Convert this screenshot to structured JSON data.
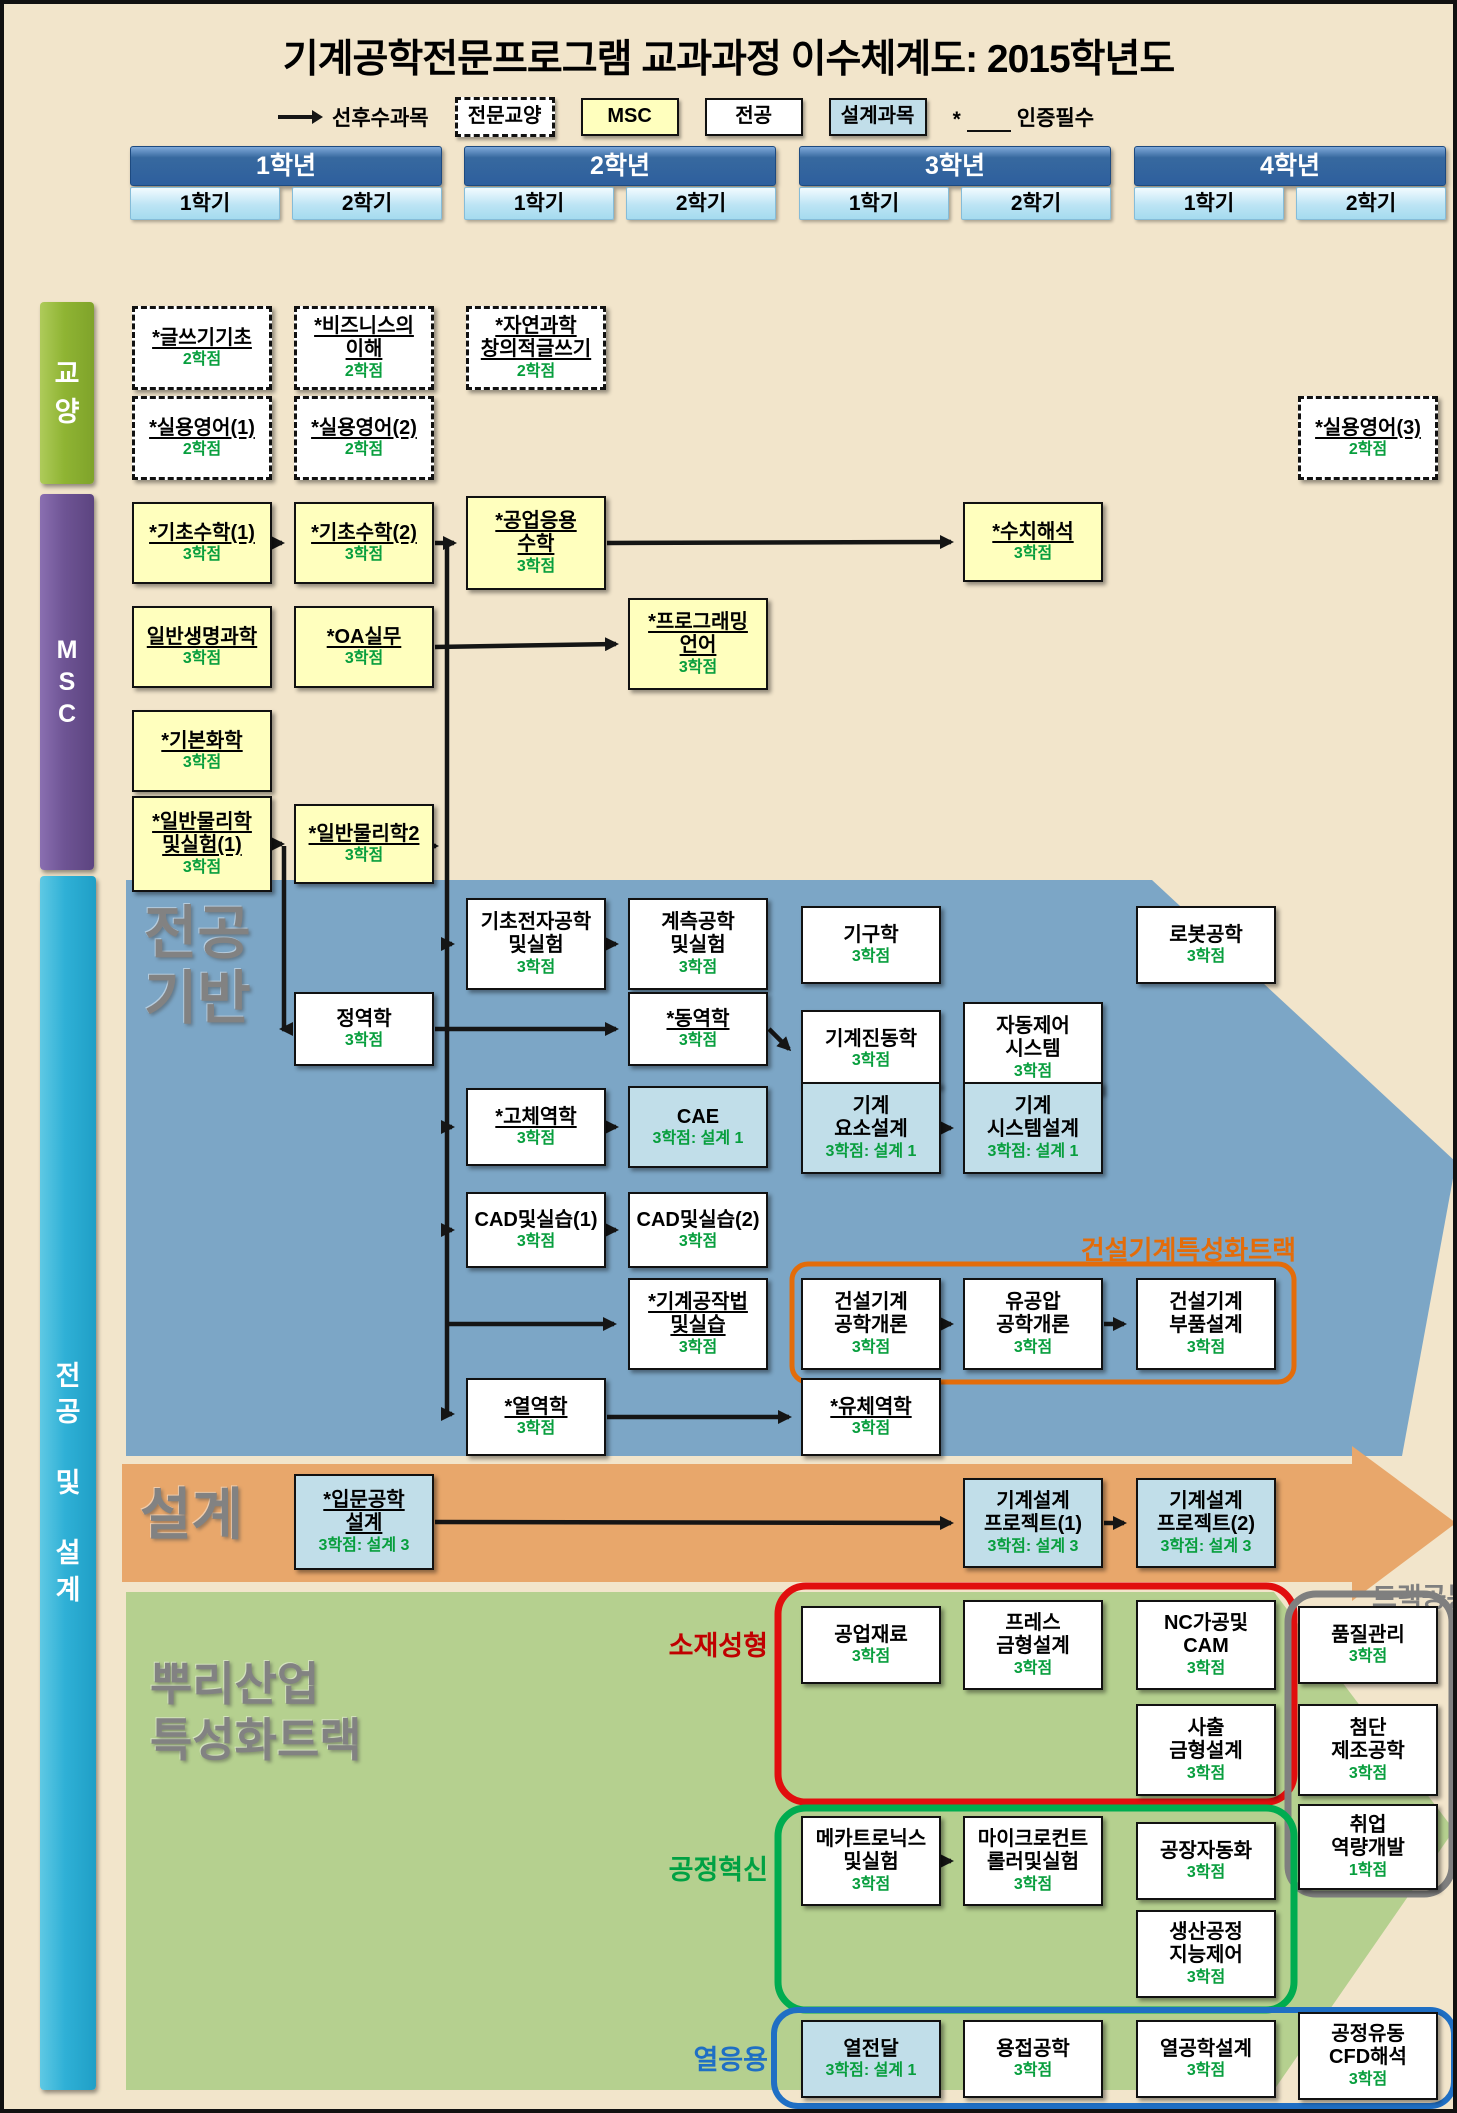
{
  "title": "기계공학전문프로그램 교과과정 이수체계도: 2015학년도",
  "legend": {
    "arrow_label": "선후수과목",
    "items": [
      {
        "label": "전문교양",
        "type": "liberal"
      },
      {
        "label": "MSC",
        "type": "msc"
      },
      {
        "label": "전공",
        "type": "major"
      },
      {
        "label": "설계과목",
        "type": "design"
      }
    ],
    "required_mark": "*",
    "required_label": "인증필수"
  },
  "years": [
    {
      "label": "1학년",
      "semesters": [
        "1학기",
        "2학기"
      ]
    },
    {
      "label": "2학년",
      "semesters": [
        "1학기",
        "2학기"
      ]
    },
    {
      "label": "3학년",
      "semesters": [
        "1학기",
        "2학기"
      ]
    },
    {
      "label": "4학년",
      "semesters": [
        "1학기",
        "2학기"
      ]
    }
  ],
  "side_sections": [
    {
      "label": "교양",
      "color": "#8FB433"
    },
    {
      "label": "MSC",
      "color": "#6E5494"
    },
    {
      "label": "전공 및 설계",
      "color": "#2FB0D6"
    }
  ],
  "regions": [
    {
      "id": "major-base",
      "label": "전공\n기반",
      "color": "#7CA6C6"
    },
    {
      "id": "design-band",
      "label": "설계",
      "color": "#E8A76B"
    },
    {
      "id": "root-industry",
      "label": "뿌리산업\n특성화트랙",
      "color": "#B5D08F"
    }
  ],
  "track_labels": [
    {
      "id": "construction",
      "text": "건설기계특성화트랙",
      "color": "#E36C0A"
    },
    {
      "id": "common",
      "text": "트랙공통",
      "color": "#7F7F7F"
    },
    {
      "id": "material",
      "text": "소재성형",
      "color": "#C00000"
    },
    {
      "id": "process",
      "text": "공정혁신",
      "color": "#00A143"
    },
    {
      "id": "thermal",
      "text": "열응용",
      "color": "#1F6FC4"
    }
  ],
  "courses": [
    {
      "id": "gs",
      "col": "1-1",
      "y": 302,
      "h": 84,
      "type": "liberal",
      "u": true,
      "lines": [
        "*글쓰기기초"
      ],
      "credit": "2학점"
    },
    {
      "id": "biz",
      "col": "1-2",
      "y": 302,
      "h": 84,
      "type": "liberal",
      "u": true,
      "lines": [
        "*비즈니스의",
        "이해"
      ],
      "credit": "2학점"
    },
    {
      "id": "nat",
      "col": "2-1",
      "y": 302,
      "h": 84,
      "type": "liberal",
      "u": true,
      "lines": [
        "*자연과학",
        "창의적글쓰기"
      ],
      "credit": "2학점"
    },
    {
      "id": "eng1",
      "col": "1-1",
      "y": 392,
      "h": 84,
      "type": "liberal",
      "u": true,
      "lines": [
        "*실용영어(1)"
      ],
      "credit": "2학점"
    },
    {
      "id": "eng2",
      "col": "1-2",
      "y": 392,
      "h": 84,
      "type": "liberal",
      "u": true,
      "lines": [
        "*실용영어(2)"
      ],
      "credit": "2학점"
    },
    {
      "id": "eng3",
      "col": "4-2",
      "y": 392,
      "h": 84,
      "type": "liberal",
      "u": true,
      "lines": [
        "*실용영어(3)"
      ],
      "credit": "2학점"
    },
    {
      "id": "math1",
      "col": "1-1",
      "y": 498,
      "h": 82,
      "type": "msc",
      "u": true,
      "lines": [
        "*기초수학(1)"
      ],
      "credit": "3학점"
    },
    {
      "id": "math2",
      "col": "1-2",
      "y": 498,
      "h": 82,
      "type": "msc",
      "u": true,
      "lines": [
        "*기초수학(2)"
      ],
      "credit": "3학점"
    },
    {
      "id": "engmath",
      "col": "2-1",
      "y": 492,
      "h": 94,
      "type": "msc",
      "u": true,
      "lines": [
        "*공업응용",
        "수학"
      ],
      "credit": "3학점"
    },
    {
      "id": "numan",
      "col": "3-2",
      "y": 498,
      "h": 80,
      "type": "msc",
      "u": true,
      "lines": [
        "*수치해석"
      ],
      "credit": "3학점"
    },
    {
      "id": "bio",
      "col": "1-1",
      "y": 602,
      "h": 82,
      "type": "msc",
      "u": true,
      "lines": [
        "일반생명과학"
      ],
      "credit": "3학점"
    },
    {
      "id": "oa",
      "col": "1-2",
      "y": 602,
      "h": 82,
      "type": "msc",
      "u": true,
      "lines": [
        "*OA실무"
      ],
      "credit": "3학점"
    },
    {
      "id": "prog",
      "col": "2-2",
      "y": 594,
      "h": 92,
      "type": "msc",
      "u": true,
      "lines": [
        "*프로그래밍",
        "언어"
      ],
      "credit": "3학점"
    },
    {
      "id": "chem",
      "col": "1-1",
      "y": 706,
      "h": 82,
      "type": "msc",
      "u": true,
      "lines": [
        "*기본화학"
      ],
      "credit": "3학점"
    },
    {
      "id": "phys1",
      "col": "1-1",
      "y": 792,
      "h": 96,
      "type": "msc",
      "u": true,
      "lines": [
        "*일반물리학",
        "및실험(1)"
      ],
      "credit": "3학점"
    },
    {
      "id": "phys2",
      "col": "1-2",
      "y": 800,
      "h": 80,
      "type": "msc",
      "u": true,
      "lines": [
        "*일반물리학2"
      ],
      "credit": "3학점"
    },
    {
      "id": "elec",
      "col": "2-1",
      "y": 894,
      "h": 92,
      "type": "major",
      "lines": [
        "기초전자공학",
        "및실험"
      ],
      "credit": "3학점"
    },
    {
      "id": "meas",
      "col": "2-2",
      "y": 894,
      "h": 92,
      "type": "major",
      "lines": [
        "계측공학",
        "및실험"
      ],
      "credit": "3학점"
    },
    {
      "id": "mech",
      "col": "3-1",
      "y": 902,
      "h": 78,
      "type": "major",
      "lines": [
        "기구학"
      ],
      "credit": "3학점"
    },
    {
      "id": "robot",
      "col": "4-1",
      "y": 902,
      "h": 78,
      "type": "major",
      "lines": [
        "로봇공학"
      ],
      "credit": "3학점"
    },
    {
      "id": "statics",
      "col": "1-2",
      "y": 988,
      "h": 74,
      "type": "major",
      "lines": [
        "정역학"
      ],
      "credit": "3학점"
    },
    {
      "id": "dyn",
      "col": "2-2",
      "y": 988,
      "h": 74,
      "type": "major",
      "u": true,
      "lines": [
        "*동역학"
      ],
      "credit": "3학점"
    },
    {
      "id": "vib",
      "col": "3-1",
      "y": 1006,
      "h": 78,
      "type": "major",
      "lines": [
        "기계진동학"
      ],
      "credit": "3학점"
    },
    {
      "id": "auto",
      "col": "3-2",
      "y": 998,
      "h": 92,
      "type": "major",
      "lines": [
        "자동제어",
        "시스템"
      ],
      "credit": "3학점"
    },
    {
      "id": "solid",
      "col": "2-1",
      "y": 1084,
      "h": 78,
      "type": "major",
      "u": true,
      "lines": [
        "*고체역학"
      ],
      "credit": "3학점"
    },
    {
      "id": "cae",
      "col": "2-2",
      "y": 1082,
      "h": 82,
      "type": "design",
      "lines": [
        "CAE"
      ],
      "credit": "3학점: 설계 1"
    },
    {
      "id": "machel",
      "col": "3-1",
      "y": 1078,
      "h": 92,
      "type": "design",
      "lines": [
        "기계",
        "요소설계"
      ],
      "credit": "3학점: 설계 1"
    },
    {
      "id": "macsys",
      "col": "3-2",
      "y": 1078,
      "h": 92,
      "type": "design",
      "lines": [
        "기계",
        "시스템설계"
      ],
      "credit": "3학점: 설계 1"
    },
    {
      "id": "cad1",
      "col": "2-1",
      "y": 1188,
      "h": 76,
      "type": "major",
      "lines": [
        "CAD및실습(1)"
      ],
      "credit": "3학점"
    },
    {
      "id": "cad2",
      "col": "2-2",
      "y": 1188,
      "h": 76,
      "type": "major",
      "lines": [
        "CAD및실습(2)"
      ],
      "credit": "3학점"
    },
    {
      "id": "manuf",
      "col": "2-2",
      "y": 1274,
      "h": 92,
      "type": "major",
      "u": true,
      "lines": [
        "*기계공작법",
        "및실습"
      ],
      "credit": "3학점"
    },
    {
      "id": "conint",
      "col": "3-1",
      "y": 1274,
      "h": 92,
      "type": "major",
      "lines": [
        "건설기계",
        "공학개론"
      ],
      "credit": "3학점"
    },
    {
      "id": "hydr",
      "col": "3-2",
      "y": 1274,
      "h": 92,
      "type": "major",
      "lines": [
        "유공압",
        "공학개론"
      ],
      "credit": "3학점"
    },
    {
      "id": "conpart",
      "col": "4-1",
      "y": 1274,
      "h": 92,
      "type": "major",
      "lines": [
        "건설기계",
        "부품설계"
      ],
      "credit": "3학점"
    },
    {
      "id": "thermo",
      "col": "2-1",
      "y": 1374,
      "h": 78,
      "type": "major",
      "u": true,
      "lines": [
        "*열역학"
      ],
      "credit": "3학점"
    },
    {
      "id": "fluid",
      "col": "3-1",
      "y": 1374,
      "h": 78,
      "type": "major",
      "u": true,
      "lines": [
        "*유체역학"
      ],
      "credit": "3학점"
    },
    {
      "id": "introdes",
      "col": "1-2",
      "y": 1470,
      "h": 96,
      "type": "design",
      "u": true,
      "lines": [
        "*입문공학",
        "설계"
      ],
      "credit": "3학점: 설계 3"
    },
    {
      "id": "proj1",
      "col": "3-2",
      "y": 1474,
      "h": 90,
      "type": "design",
      "lines": [
        "기계설계",
        "프로젝트(1)"
      ],
      "credit": "3학점: 설계 3"
    },
    {
      "id": "proj2",
      "col": "4-1",
      "y": 1474,
      "h": 90,
      "type": "design",
      "lines": [
        "기계설계",
        "프로젝트(2)"
      ],
      "credit": "3학점: 설계 3"
    },
    {
      "id": "indmat",
      "col": "3-1",
      "y": 1602,
      "h": 78,
      "type": "major",
      "lines": [
        "공업재료"
      ],
      "credit": "3학점"
    },
    {
      "id": "press",
      "col": "3-2",
      "y": 1596,
      "h": 90,
      "type": "major",
      "lines": [
        "프레스",
        "금형설계"
      ],
      "credit": "3학점"
    },
    {
      "id": "nccam",
      "col": "4-1",
      "y": 1596,
      "h": 90,
      "type": "major",
      "lines": [
        "NC가공및",
        "CAM"
      ],
      "credit": "3학점"
    },
    {
      "id": "quality",
      "col": "4-2",
      "y": 1602,
      "h": 78,
      "type": "major",
      "lines": [
        "품질관리"
      ],
      "credit": "3학점"
    },
    {
      "id": "inject",
      "col": "4-1",
      "y": 1700,
      "h": 92,
      "type": "major",
      "lines": [
        "사출",
        "금형설계"
      ],
      "credit": "3학점"
    },
    {
      "id": "advman",
      "col": "4-2",
      "y": 1700,
      "h": 92,
      "type": "major",
      "lines": [
        "첨단",
        "제조공학"
      ],
      "credit": "3학점"
    },
    {
      "id": "mecha",
      "col": "3-1",
      "y": 1812,
      "h": 90,
      "type": "major",
      "lines": [
        "메카트로닉스",
        "및실험"
      ],
      "credit": "3학점"
    },
    {
      "id": "micro",
      "col": "3-2",
      "y": 1812,
      "h": 90,
      "type": "major",
      "lines": [
        "마이크로컨트",
        "롤러및실험"
      ],
      "credit": "3학점"
    },
    {
      "id": "factauto",
      "col": "4-1",
      "y": 1818,
      "h": 78,
      "type": "major",
      "lines": [
        "공장자동화"
      ],
      "credit": "3학점"
    },
    {
      "id": "career",
      "col": "4-2",
      "y": 1800,
      "h": 86,
      "type": "major",
      "lines": [
        "취업",
        "역량개발"
      ],
      "credit": "1학점"
    },
    {
      "id": "prodctl",
      "col": "4-1",
      "y": 1906,
      "h": 88,
      "type": "major",
      "lines": [
        "생산공정",
        "지능제어"
      ],
      "credit": "3학점"
    },
    {
      "id": "heat",
      "col": "3-1",
      "y": 2016,
      "h": 78,
      "type": "design",
      "lines": [
        "열전달"
      ],
      "credit": "3학점: 설계 1"
    },
    {
      "id": "weld",
      "col": "3-2",
      "y": 2016,
      "h": 78,
      "type": "major",
      "lines": [
        "용접공학"
      ],
      "credit": "3학점"
    },
    {
      "id": "thermdes",
      "col": "4-1",
      "y": 2016,
      "h": 78,
      "type": "major",
      "lines": [
        "열공학설계"
      ],
      "credit": "3학점"
    },
    {
      "id": "cfd",
      "col": "4-2",
      "y": 2008,
      "h": 88,
      "type": "major",
      "lines": [
        "공정유동",
        "CFD해석"
      ],
      "credit": "3학점"
    }
  ],
  "links": [
    {
      "from": "math1",
      "to": "math2"
    },
    {
      "from": "math2",
      "to": "engmath"
    },
    {
      "from": "engmath",
      "to": "numan"
    },
    {
      "from": "oa",
      "to": "prog"
    },
    {
      "from": "phys1",
      "to": "phys2"
    },
    {
      "from": "elec",
      "to": "meas"
    },
    {
      "from": "statics",
      "to": "dyn"
    },
    {
      "from": "dyn",
      "to": "vib"
    },
    {
      "from": "solid",
      "to": "cae"
    },
    {
      "from": "machel",
      "to": "macsys"
    },
    {
      "from": "cad1",
      "to": "cad2"
    },
    {
      "from": "conint",
      "to": "hydr"
    },
    {
      "from": "hydr",
      "to": "conpart"
    },
    {
      "from": "thermo",
      "to": "fluid"
    },
    {
      "from": "introdes",
      "to": "proj1"
    },
    {
      "from": "proj1",
      "to": "proj2"
    },
    {
      "from": "mecha",
      "to": "micro"
    }
  ]
}
